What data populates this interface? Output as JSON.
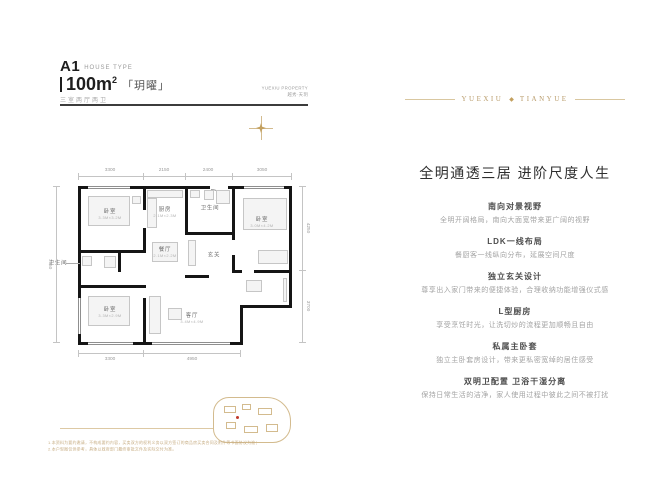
{
  "header": {
    "type_code": "A1",
    "type_suffix": "HOUSE TYPE",
    "area_value": "100m",
    "area_sup": "2",
    "suite_name": "「玥曜」",
    "layout_text": "三室两厅两卫",
    "brand_line1": "YUEXIU PROPERTY",
    "brand_line2": "越秀·天玥"
  },
  "banner": {
    "left": "YUEXIU",
    "diamond": "◆",
    "right": "TIANYUE"
  },
  "plan": {
    "rooms": [
      {
        "name": "卧室",
        "size": "3.3M×3.2M"
      },
      {
        "name": "卧室",
        "size": "3.3M×2.9M"
      },
      {
        "name": "卧室",
        "size": "3.0M×4.2M"
      },
      {
        "name": "厨房",
        "size": "2.1M×2.3M"
      },
      {
        "name": "餐厅",
        "size": "2.1M×2.2M"
      },
      {
        "name": "客厅",
        "size": "3.4M×4.9M"
      },
      {
        "name": "卫生间",
        "size": ""
      },
      {
        "name": "玄关",
        "size": ""
      },
      {
        "name": "卫生间",
        "size": ""
      }
    ],
    "dims": {
      "top": [
        "3300",
        "2150",
        "2400",
        "3050"
      ],
      "bottom": [
        "3300",
        "4950"
      ],
      "right": [
        "4250",
        "3700"
      ],
      "left": [
        "7950"
      ]
    }
  },
  "right_panel": {
    "title": "全明通透三居 进阶尺度人生",
    "sections": [
      {
        "heading": "南向对景视野",
        "body": "全明开阔格局，南向大面宽带来更广阔的视野"
      },
      {
        "heading": "LDK一线布局",
        "body": "餐厨客一线纵向分布，延展空间尺度"
      },
      {
        "heading": "独立玄关设计",
        "body": "尊享出入家门带来的便捷体验，合理收纳功能增强仪式感"
      },
      {
        "heading": "L型厨房",
        "body": "享受烹饪时光，让洗切炒的流程更加顺畅且自由"
      },
      {
        "heading": "私属主卧套",
        "body": "独立主卧套房设计，带来更私密宽绰的居住感受"
      },
      {
        "heading": "双明卫配置 卫浴干湿分离",
        "body": "保持日常生活的洁净，家人使用过程中彼此之间不被打扰"
      }
    ]
  },
  "footer": {
    "disclaimer_line1": "1.本资料为要约邀请，不构成要约内容，买卖双方的权利义务以双方签订的商品房买卖合同及附件等书面协议为准；",
    "disclaimer_line2": "2.本户型图仅供参考，具体以政府部门最终审批文件及实际交付为准。"
  },
  "colors": {
    "gold": "#bfa272",
    "ink": "#222222",
    "gray": "#999999",
    "red": "#c0392b"
  }
}
